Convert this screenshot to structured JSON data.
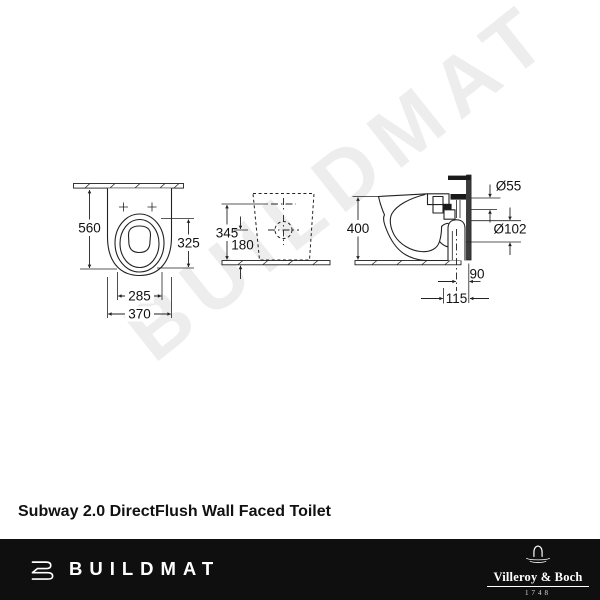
{
  "watermark": {
    "text": "BUILDMAT"
  },
  "title": "Subway 2.0 DirectFlush Wall Faced Toilet",
  "diagram": {
    "front_view": {
      "height": "560",
      "bowl_depth": "325",
      "seat_width": "285",
      "width": "370"
    },
    "rear_view": {
      "inlet_height": "345",
      "outlet_height": "180"
    },
    "side_view": {
      "height": "400",
      "inlet_diameter": "Ø55",
      "outlet_diameter": "Ø102",
      "outlet_to_wall": "90",
      "outlet_setout": "115"
    }
  },
  "footer": {
    "brand": "BUILDMAT",
    "manufacturer": "Villeroy & Boch",
    "established": "1748"
  },
  "colors": {
    "footer_bg": "#0f0f0f",
    "line": "#222222",
    "watermark": "#ededed",
    "title_text": "#111111",
    "footer_text": "#ffffff"
  }
}
